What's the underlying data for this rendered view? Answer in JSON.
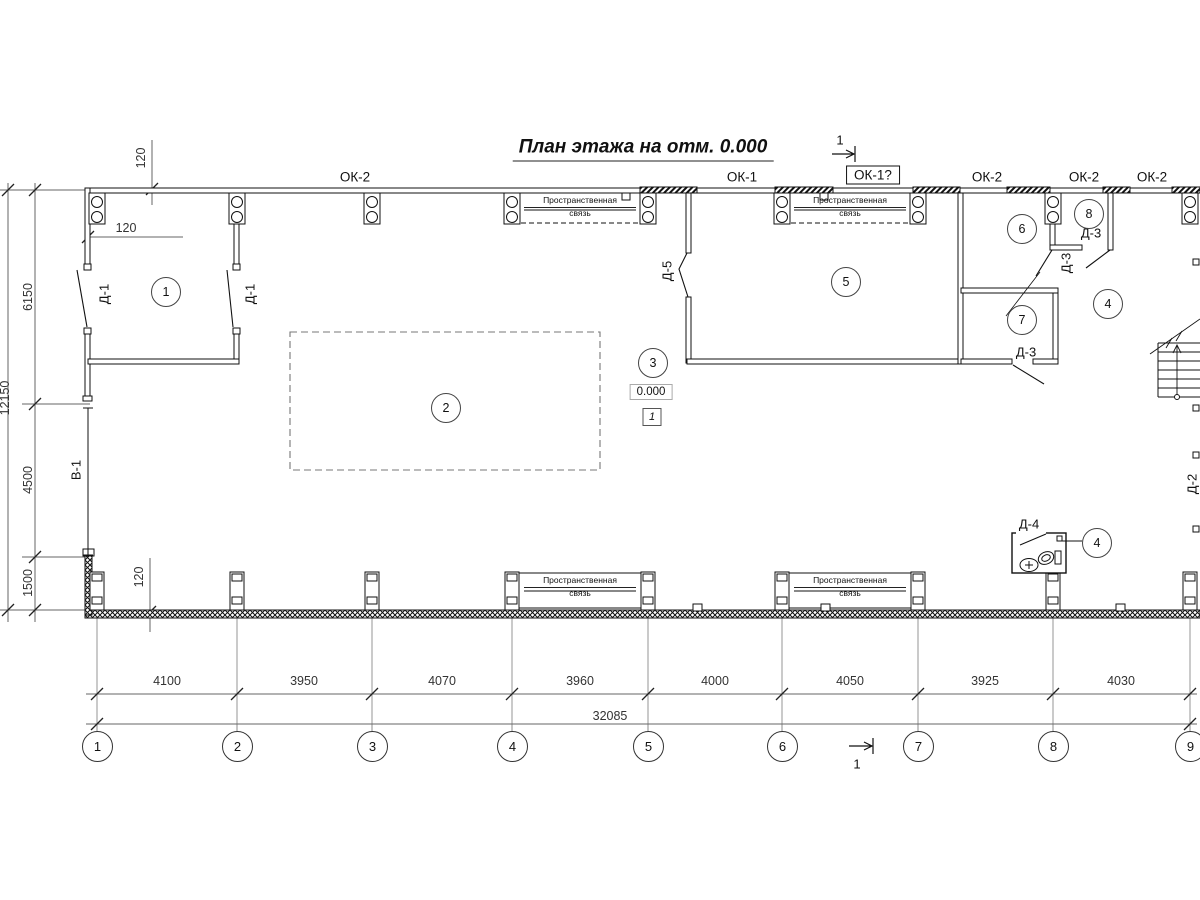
{
  "title": "План этажа на отм. 0.000",
  "section_marks": {
    "top": "1",
    "bottom": "1"
  },
  "windows": {
    "ok2_a": "ОК-2",
    "ok1": "ОК-1",
    "ok1_q": "ОК-1?",
    "ok2_b": "ОК-2",
    "ok2_c": "ОК-2",
    "ok2_d": "ОК-2"
  },
  "doors": {
    "d1_left": "Д-1",
    "d1_mid": "Д-1",
    "d5": "Д-5",
    "d3_room8": "Д-3",
    "d3_corridor": "Д-3",
    "d3_room7": "Д-3",
    "d4": "Д-4",
    "d2": "Д-2",
    "v1": "В-1"
  },
  "rooms": {
    "r1": "1",
    "r2": "2",
    "r3": "3",
    "r4a": "4",
    "r4b": "4",
    "r5": "5",
    "r6": "6",
    "r7": "7",
    "r8": "8"
  },
  "elevation": {
    "value": "0.000",
    "zone": "1"
  },
  "brace": {
    "line1": "Пространственная",
    "line2": "связь"
  },
  "dims": {
    "top_offset": "120",
    "left_wall_offset": "120",
    "bottom_offset": "120",
    "left": [
      "6150",
      "4500",
      "1500"
    ],
    "left_total": "12150",
    "bottom": [
      "4100",
      "3950",
      "4070",
      "3960",
      "4000",
      "4050",
      "3925",
      "4030"
    ],
    "bottom_total": "32085"
  },
  "grid": [
    "1",
    "2",
    "3",
    "4",
    "5",
    "6",
    "7",
    "8",
    "9"
  ]
}
